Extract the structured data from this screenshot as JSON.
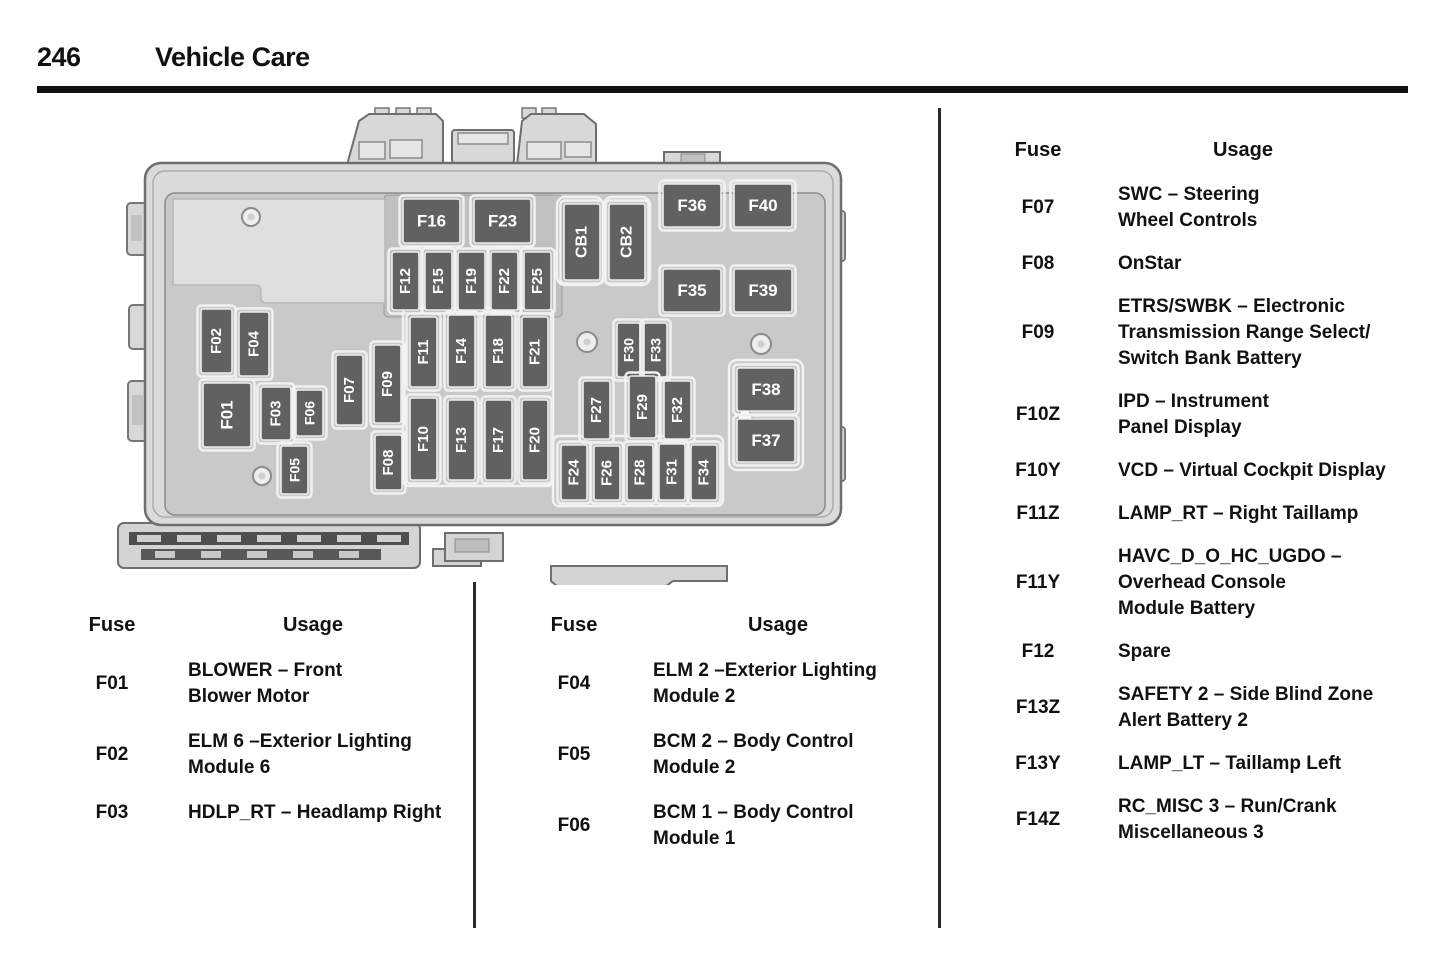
{
  "page": {
    "number": "246",
    "title": "Vehicle Care"
  },
  "diagram": {
    "colors": {
      "fuse_fill": "#616161",
      "fuse_stroke": "#ededed",
      "fuse_text": "#ffffff",
      "body_fill": "#dadada",
      "body_stroke": "#6e6e6e",
      "panel_fill": "#c9c9c9"
    },
    "fuses": [
      {
        "id": "F16",
        "x": 288,
        "y": 94,
        "w": 57,
        "h": 44,
        "o": "h"
      },
      {
        "id": "F23",
        "x": 359,
        "y": 94,
        "w": 57,
        "h": 44,
        "o": "h"
      },
      {
        "id": "F36",
        "x": 548,
        "y": 79,
        "w": 58,
        "h": 43,
        "o": "h"
      },
      {
        "id": "F40",
        "x": 619,
        "y": 79,
        "w": 58,
        "h": 43,
        "o": "h"
      },
      {
        "id": "F35",
        "x": 548,
        "y": 164,
        "w": 58,
        "h": 43,
        "o": "h"
      },
      {
        "id": "F39",
        "x": 619,
        "y": 164,
        "w": 58,
        "h": 43,
        "o": "h"
      },
      {
        "id": "F38",
        "x": 622,
        "y": 263,
        "w": 58,
        "h": 43,
        "o": "h"
      },
      {
        "id": "F37",
        "x": 622,
        "y": 314,
        "w": 58,
        "h": 43,
        "o": "h"
      },
      {
        "id": "CB1",
        "x": 449,
        "y": 99,
        "w": 36,
        "h": 76,
        "o": "v",
        "fs": 16
      },
      {
        "id": "CB2",
        "x": 494,
        "y": 99,
        "w": 36,
        "h": 76,
        "o": "v",
        "fs": 16
      },
      {
        "id": "F12",
        "x": 277,
        "y": 147,
        "w": 27,
        "h": 58,
        "o": "v"
      },
      {
        "id": "F15",
        "x": 310,
        "y": 147,
        "w": 27,
        "h": 58,
        "o": "v"
      },
      {
        "id": "F19",
        "x": 343,
        "y": 147,
        "w": 27,
        "h": 58,
        "o": "v"
      },
      {
        "id": "F22",
        "x": 376,
        "y": 147,
        "w": 27,
        "h": 58,
        "o": "v"
      },
      {
        "id": "F25",
        "x": 409,
        "y": 147,
        "w": 27,
        "h": 58,
        "o": "v"
      },
      {
        "id": "F02",
        "x": 86,
        "y": 204,
        "w": 31,
        "h": 64,
        "o": "v"
      },
      {
        "id": "F04",
        "x": 124,
        "y": 207,
        "w": 30,
        "h": 64,
        "o": "v"
      },
      {
        "id": "F01",
        "x": 88,
        "y": 278,
        "w": 48,
        "h": 64,
        "o": "v",
        "fs": 17
      },
      {
        "id": "F03",
        "x": 146,
        "y": 282,
        "w": 30,
        "h": 53,
        "o": "v"
      },
      {
        "id": "F06",
        "x": 181,
        "y": 285,
        "w": 27,
        "h": 46,
        "o": "v",
        "fs": 14
      },
      {
        "id": "F05",
        "x": 166,
        "y": 341,
        "w": 27,
        "h": 48,
        "o": "v",
        "fs": 14
      },
      {
        "id": "F07",
        "x": 221,
        "y": 250,
        "w": 27,
        "h": 70,
        "o": "v"
      },
      {
        "id": "F09",
        "x": 259,
        "y": 240,
        "w": 27,
        "h": 78,
        "o": "v"
      },
      {
        "id": "F08",
        "x": 260,
        "y": 330,
        "w": 27,
        "h": 55,
        "o": "v"
      },
      {
        "id": "F11",
        "x": 295,
        "y": 212,
        "w": 27,
        "h": 70,
        "o": "v"
      },
      {
        "id": "F14",
        "x": 333,
        "y": 210,
        "w": 27,
        "h": 72,
        "o": "v"
      },
      {
        "id": "F18",
        "x": 370,
        "y": 210,
        "w": 27,
        "h": 72,
        "o": "v"
      },
      {
        "id": "F21",
        "x": 407,
        "y": 212,
        "w": 26,
        "h": 70,
        "o": "v"
      },
      {
        "id": "F10",
        "x": 295,
        "y": 293,
        "w": 27,
        "h": 82,
        "o": "v"
      },
      {
        "id": "F13",
        "x": 333,
        "y": 295,
        "w": 27,
        "h": 80,
        "o": "v"
      },
      {
        "id": "F17",
        "x": 370,
        "y": 295,
        "w": 27,
        "h": 80,
        "o": "v"
      },
      {
        "id": "F20",
        "x": 407,
        "y": 295,
        "w": 26,
        "h": 80,
        "o": "v"
      },
      {
        "id": "F30",
        "x": 502,
        "y": 218,
        "w": 23,
        "h": 54,
        "o": "v",
        "fs": 14
      },
      {
        "id": "F33",
        "x": 529,
        "y": 218,
        "w": 23,
        "h": 54,
        "o": "v",
        "fs": 14
      },
      {
        "id": "F27",
        "x": 468,
        "y": 276,
        "w": 27,
        "h": 58,
        "o": "v"
      },
      {
        "id": "F29",
        "x": 514,
        "y": 271,
        "w": 27,
        "h": 62,
        "o": "v"
      },
      {
        "id": "F32",
        "x": 549,
        "y": 276,
        "w": 27,
        "h": 58,
        "o": "v"
      },
      {
        "id": "F24",
        "x": 446,
        "y": 340,
        "w": 26,
        "h": 55,
        "o": "v"
      },
      {
        "id": "F26",
        "x": 479,
        "y": 341,
        "w": 26,
        "h": 54,
        "o": "v"
      },
      {
        "id": "F28",
        "x": 512,
        "y": 340,
        "w": 26,
        "h": 55,
        "o": "v"
      },
      {
        "id": "F31",
        "x": 544,
        "y": 339,
        "w": 26,
        "h": 56,
        "o": "v"
      },
      {
        "id": "F34",
        "x": 576,
        "y": 340,
        "w": 26,
        "h": 55,
        "o": "v"
      }
    ]
  },
  "tables": {
    "left": {
      "headers": {
        "fuse": "Fuse",
        "usage": "Usage"
      },
      "rows": [
        {
          "fuse": "F01",
          "usage_lines": [
            "BLOWER – Front",
            "Blower Motor"
          ]
        },
        {
          "fuse": "F02",
          "usage_lines": [
            "ELM 6 –Exterior Lighting",
            "Module 6"
          ]
        },
        {
          "fuse": "F03",
          "usage_lines": [
            "HDLP_RT – Headlamp Right"
          ]
        }
      ]
    },
    "middle": {
      "headers": {
        "fuse": "Fuse",
        "usage": "Usage"
      },
      "rows": [
        {
          "fuse": "F04",
          "usage_lines": [
            "ELM 2 –Exterior Lighting",
            "Module 2"
          ]
        },
        {
          "fuse": "F05",
          "usage_lines": [
            "BCM 2 – Body Control",
            "Module 2"
          ]
        },
        {
          "fuse": "F06",
          "usage_lines": [
            "BCM 1 – Body Control",
            "Module 1"
          ]
        }
      ]
    },
    "right": {
      "headers": {
        "fuse": "Fuse",
        "usage": "Usage"
      },
      "rows": [
        {
          "fuse": "F07",
          "usage_lines": [
            "SWC – Steering",
            "Wheel Controls"
          ]
        },
        {
          "fuse": "F08",
          "usage_lines": [
            "OnStar"
          ]
        },
        {
          "fuse": "F09",
          "usage_lines": [
            "ETRS/SWBK – Electronic",
            "Transmission Range Select/",
            "Switch Bank Battery"
          ]
        },
        {
          "fuse": "F10Z",
          "usage_lines": [
            "IPD – Instrument",
            "Panel Display"
          ]
        },
        {
          "fuse": "F10Y",
          "usage_lines": [
            "VCD – Virtual Cockpit Display"
          ]
        },
        {
          "fuse": "F11Z",
          "usage_lines": [
            "LAMP_RT – Right Taillamp"
          ]
        },
        {
          "fuse": "F11Y",
          "usage_lines": [
            "HAVC_D_O_HC_UGDO –",
            "Overhead Console",
            "Module Battery"
          ]
        },
        {
          "fuse": "F12",
          "usage_lines": [
            "Spare"
          ]
        },
        {
          "fuse": "F13Z",
          "usage_lines": [
            "SAFETY 2 – Side Blind Zone",
            "Alert Battery 2"
          ]
        },
        {
          "fuse": "F13Y",
          "usage_lines": [
            "LAMP_LT – Taillamp Left"
          ]
        },
        {
          "fuse": "F14Z",
          "usage_lines": [
            "RC_MISC 3 – Run/Crank",
            "Miscellaneous 3"
          ]
        }
      ]
    }
  }
}
